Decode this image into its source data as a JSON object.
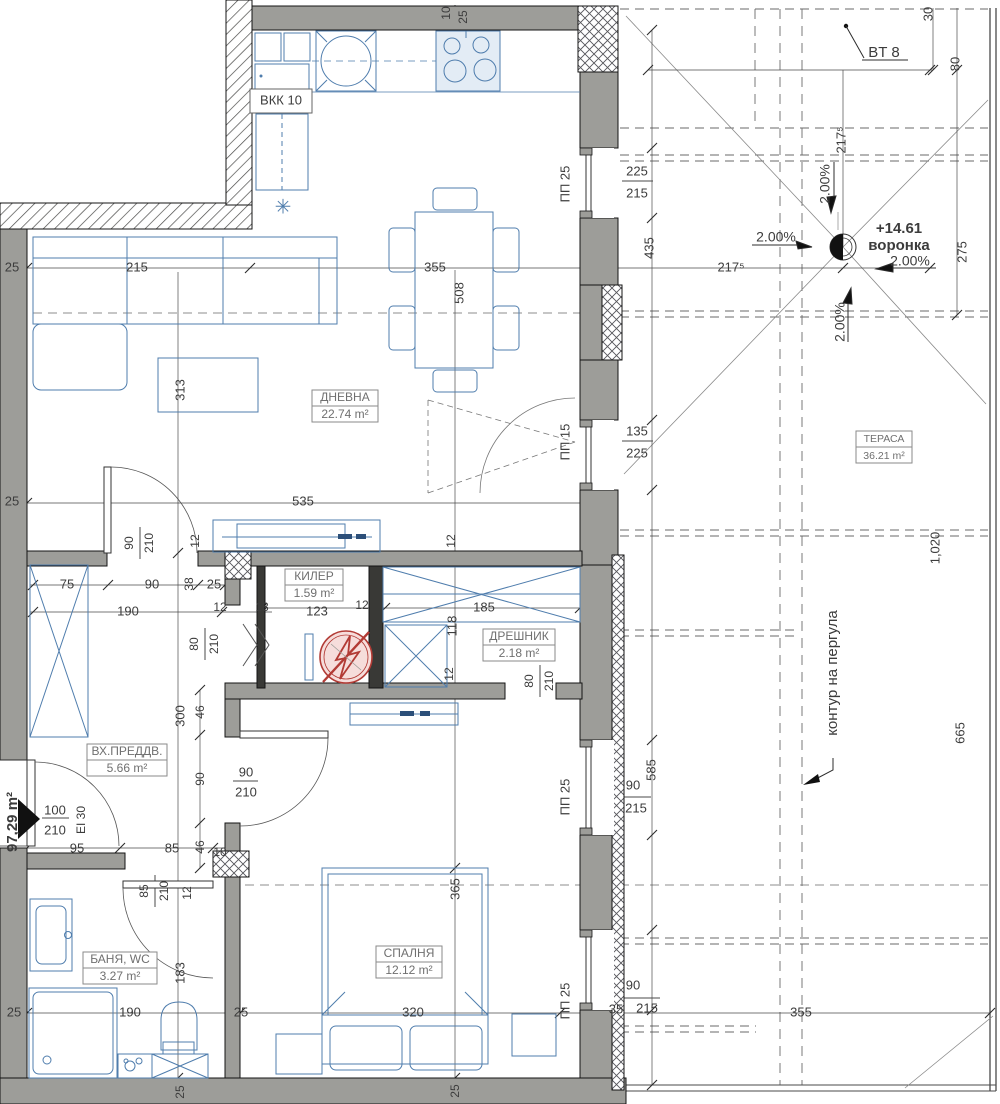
{
  "drawing": {
    "kind": "apartment floor plan with terrace",
    "total_area_label": "97,29 m²"
  },
  "colors": {
    "wall_gray": "#9d9d99",
    "wall_dark": "#393936",
    "furniture_blue": "#4f7dad",
    "appliance_fill": "#e3ecf5",
    "dim_text": "#3c3c3c",
    "room_text": "#6f6f6f",
    "red_symbol": "#b23b35",
    "red_symbol_fill": "#f6dddb"
  },
  "rooms": [
    {
      "id": "dnevna",
      "name": "ДНЕВНА",
      "area": "22.74 m²",
      "x": 345,
      "y": 406,
      "w": 66,
      "fs": 12
    },
    {
      "id": "kiler",
      "name": "КИЛЕР",
      "area": "1.59 m²",
      "x": 314,
      "y": 585,
      "w": 58,
      "fs": 12
    },
    {
      "id": "dreshnik",
      "name": "ДРЕШНИК",
      "area": "2.18 m²",
      "x": 519,
      "y": 645,
      "w": 72,
      "fs": 12
    },
    {
      "id": "vhpredv",
      "name": "ВХ.ПРЕДДВ.",
      "area": "5.66 m²",
      "x": 127,
      "y": 760,
      "w": 80,
      "fs": 12
    },
    {
      "id": "banya",
      "name": "БАНЯ, WC",
      "area": "3.27 m²",
      "x": 120,
      "y": 968,
      "w": 74,
      "fs": 12
    },
    {
      "id": "spalnya",
      "name": "СПАЛНЯ",
      "area": "12.12 m²",
      "x": 409,
      "y": 962,
      "w": 66,
      "fs": 12
    },
    {
      "id": "terasa",
      "name": "ТЕРАСА",
      "area": "36.21 m²",
      "x": 884,
      "y": 447,
      "w": 56,
      "fs": 10.5
    }
  ],
  "labels": [
    {
      "n": "dim",
      "t": "25",
      "x": 12,
      "y": 268
    },
    {
      "n": "dim",
      "t": "215",
      "x": 137,
      "y": 268
    },
    {
      "n": "dim",
      "t": "355",
      "x": 435,
      "y": 268
    },
    {
      "n": "dim",
      "t": "508",
      "x": 460,
      "y": 293,
      "r": 1
    },
    {
      "n": "dim",
      "t": "217⁵",
      "x": 731,
      "y": 268
    },
    {
      "n": "dim",
      "t": "275",
      "x": 963,
      "y": 252,
      "r": 1
    },
    {
      "n": "dim",
      "t": "313",
      "x": 181,
      "y": 390,
      "r": 1
    },
    {
      "n": "dim",
      "t": "535",
      "x": 303,
      "y": 502
    },
    {
      "n": "dim",
      "t": "25",
      "x": 12,
      "y": 502
    },
    {
      "n": "dim",
      "t": "10",
      "x": 447,
      "y": 13,
      "r": 1,
      "fs": 12
    },
    {
      "n": "dim",
      "t": "25",
      "x": 464,
      "y": 17,
      "r": 1,
      "fs": 12
    },
    {
      "n": "dim",
      "t": "30",
      "x": 929,
      "y": 14,
      "r": 1
    },
    {
      "n": "dim",
      "t": "80",
      "x": 956,
      "y": 64,
      "r": 1
    },
    {
      "n": "dim",
      "t": "217⁵",
      "x": 842,
      "y": 140,
      "r": 1
    },
    {
      "n": "bt8-label",
      "t": "BT 8",
      "x": 884,
      "y": 53,
      "fs": 15
    },
    {
      "n": "slope-label",
      "t": "2.00%",
      "x": 776,
      "y": 238,
      "fs": 14
    },
    {
      "n": "slope-label",
      "t": "2.00%",
      "x": 826,
      "y": 184,
      "r": 1,
      "fs": 14
    },
    {
      "n": "slope-label",
      "t": "2.00%",
      "x": 910,
      "y": 262,
      "fs": 14
    },
    {
      "n": "slope-label",
      "t": "2.00%",
      "x": 841,
      "y": 322,
      "r": 1,
      "fs": 14
    },
    {
      "n": "drain-level",
      "t": "+14.61",
      "x": 899,
      "y": 229,
      "b": 1,
      "fs": 15
    },
    {
      "n": "drain-name",
      "t": "воронка",
      "x": 899,
      "y": 246,
      "b": 1,
      "fs": 15
    },
    {
      "n": "dim",
      "t": "225",
      "x": 637,
      "y": 172
    },
    {
      "n": "dim",
      "t": "215",
      "x": 637,
      "y": 194
    },
    {
      "n": "dim",
      "t": "ПП 25",
      "x": 566,
      "y": 184,
      "r": 1
    },
    {
      "n": "dim",
      "t": "435",
      "x": 650,
      "y": 248,
      "r": 1
    },
    {
      "n": "dim",
      "t": "135",
      "x": 637,
      "y": 432
    },
    {
      "n": "dim",
      "t": "225",
      "x": 637,
      "y": 454
    },
    {
      "n": "dim",
      "t": "ПП 15",
      "x": 566,
      "y": 442,
      "r": 1
    },
    {
      "n": "dim",
      "t": "1,020",
      "x": 936,
      "y": 548,
      "r": 1
    },
    {
      "n": "dim",
      "t": "665",
      "x": 961,
      "y": 733,
      "r": 1
    },
    {
      "n": "pergola-note",
      "t": "контур на пергула",
      "x": 833,
      "y": 673,
      "r": 1,
      "fs": 15
    },
    {
      "n": "dim",
      "t": "90",
      "x": 130,
      "y": 543,
      "r": 1,
      "fs": 12
    },
    {
      "n": "dim",
      "t": "210",
      "x": 150,
      "y": 543,
      "r": 1,
      "fs": 12
    },
    {
      "n": "dim",
      "t": "12",
      "x": 196,
      "y": 541,
      "r": 1,
      "fs": 12
    },
    {
      "n": "dim",
      "t": "12",
      "x": 452,
      "y": 541,
      "r": 1,
      "fs": 12
    },
    {
      "n": "dim",
      "t": "75",
      "x": 67,
      "y": 585
    },
    {
      "n": "dim",
      "t": "90",
      "x": 152,
      "y": 585
    },
    {
      "n": "dim",
      "t": "38",
      "x": 190,
      "y": 584,
      "r": 1,
      "fs": 12
    },
    {
      "n": "dim",
      "t": "25",
      "x": 214,
      "y": 585
    },
    {
      "n": "dim",
      "t": "190",
      "x": 128,
      "y": 612
    },
    {
      "n": "dim",
      "t": "12",
      "x": 220,
      "y": 608,
      "fs": 12
    },
    {
      "n": "dim",
      "t": "13",
      "x": 262,
      "y": 608,
      "fs": 12
    },
    {
      "n": "dim",
      "t": "80",
      "x": 195,
      "y": 644,
      "r": 1,
      "fs": 12
    },
    {
      "n": "dim",
      "t": "210",
      "x": 215,
      "y": 644,
      "r": 1,
      "fs": 12
    },
    {
      "n": "dim",
      "t": "123",
      "x": 317,
      "y": 612
    },
    {
      "n": "dim",
      "t": "12",
      "x": 362,
      "y": 606,
      "fs": 12
    },
    {
      "n": "dim",
      "t": "185",
      "x": 484,
      "y": 608
    },
    {
      "n": "dim",
      "t": "118",
      "x": 453,
      "y": 626,
      "r": 1
    },
    {
      "n": "dim",
      "t": "12",
      "x": 450,
      "y": 674,
      "r": 1,
      "fs": 12
    },
    {
      "n": "dim",
      "t": "80",
      "x": 530,
      "y": 681,
      "r": 1,
      "fs": 12
    },
    {
      "n": "dim",
      "t": "210",
      "x": 550,
      "y": 681,
      "r": 1,
      "fs": 12
    },
    {
      "n": "dim",
      "t": "300",
      "x": 181,
      "y": 716,
      "r": 1
    },
    {
      "n": "dim",
      "t": "46",
      "x": 201,
      "y": 712,
      "r": 1,
      "fs": 12
    },
    {
      "n": "dim",
      "t": "90",
      "x": 201,
      "y": 779,
      "r": 1,
      "fs": 12
    },
    {
      "n": "dim",
      "t": "90",
      "x": 246,
      "y": 773,
      "fs": 13
    },
    {
      "n": "dim",
      "t": "210",
      "x": 246,
      "y": 793,
      "fs": 13
    },
    {
      "n": "dim",
      "t": "95",
      "x": 77,
      "y": 849
    },
    {
      "n": "dim",
      "t": "85",
      "x": 172,
      "y": 849
    },
    {
      "n": "dim",
      "t": "46",
      "x": 201,
      "y": 847,
      "r": 1,
      "fs": 12
    },
    {
      "n": "dim",
      "t": "10",
      "x": 220,
      "y": 853,
      "fs": 12
    },
    {
      "n": "total-area",
      "t": "97,29 m²",
      "x": 13,
      "y": 822,
      "r": 1,
      "b": 1,
      "fs": 15
    },
    {
      "n": "dim",
      "t": "100",
      "x": 55,
      "y": 811,
      "fs": 13
    },
    {
      "n": "dim",
      "t": "210",
      "x": 55,
      "y": 831,
      "fs": 13
    },
    {
      "n": "dim",
      "t": "EI 30",
      "x": 82,
      "y": 820,
      "r": 1,
      "fs": 12
    },
    {
      "n": "dim",
      "t": "85",
      "x": 145,
      "y": 891,
      "r": 1,
      "fs": 12
    },
    {
      "n": "dim",
      "t": "210",
      "x": 165,
      "y": 891,
      "r": 1,
      "fs": 12
    },
    {
      "n": "dim",
      "t": "12",
      "x": 188,
      "y": 893,
      "r": 1,
      "fs": 12
    },
    {
      "n": "dim",
      "t": "183",
      "x": 181,
      "y": 973,
      "r": 1
    },
    {
      "n": "dim",
      "t": "190",
      "x": 130,
      "y": 1013
    },
    {
      "n": "dim",
      "t": "25",
      "x": 14,
      "y": 1013
    },
    {
      "n": "dim",
      "t": "25",
      "x": 241,
      "y": 1013
    },
    {
      "n": "dim",
      "t": "320",
      "x": 413,
      "y": 1013
    },
    {
      "n": "dim",
      "t": "365",
      "x": 456,
      "y": 889,
      "r": 1
    },
    {
      "n": "dim",
      "t": "25",
      "x": 456,
      "y": 1091,
      "r": 1,
      "fs": 12
    },
    {
      "n": "dim",
      "t": "25",
      "x": 181,
      "y": 1092,
      "r": 1,
      "fs": 12
    },
    {
      "n": "dim",
      "t": "ПП 25",
      "x": 566,
      "y": 797,
      "r": 1
    },
    {
      "n": "dim",
      "t": "90",
      "x": 633,
      "y": 786
    },
    {
      "n": "dim",
      "t": "215",
      "x": 636,
      "y": 809
    },
    {
      "n": "dim",
      "t": "585",
      "x": 652,
      "y": 770,
      "r": 1
    },
    {
      "n": "dim",
      "t": "ПП 25",
      "x": 566,
      "y": 1001,
      "r": 1
    },
    {
      "n": "dim",
      "t": "90",
      "x": 633,
      "y": 986
    },
    {
      "n": "dim",
      "t": "35",
      "x": 616,
      "y": 1010
    },
    {
      "n": "dim",
      "t": "215",
      "x": 647,
      "y": 1009
    },
    {
      "n": "dim",
      "t": "355",
      "x": 801,
      "y": 1013
    },
    {
      "n": "vkk-label",
      "t": "ВКК 10",
      "x": 281,
      "y": 101,
      "fs": 13
    },
    {
      "n": "radiator-symbol",
      "t": "✳",
      "x": 283,
      "y": 208,
      "fs": 20,
      "c": "#4f7dad"
    }
  ]
}
